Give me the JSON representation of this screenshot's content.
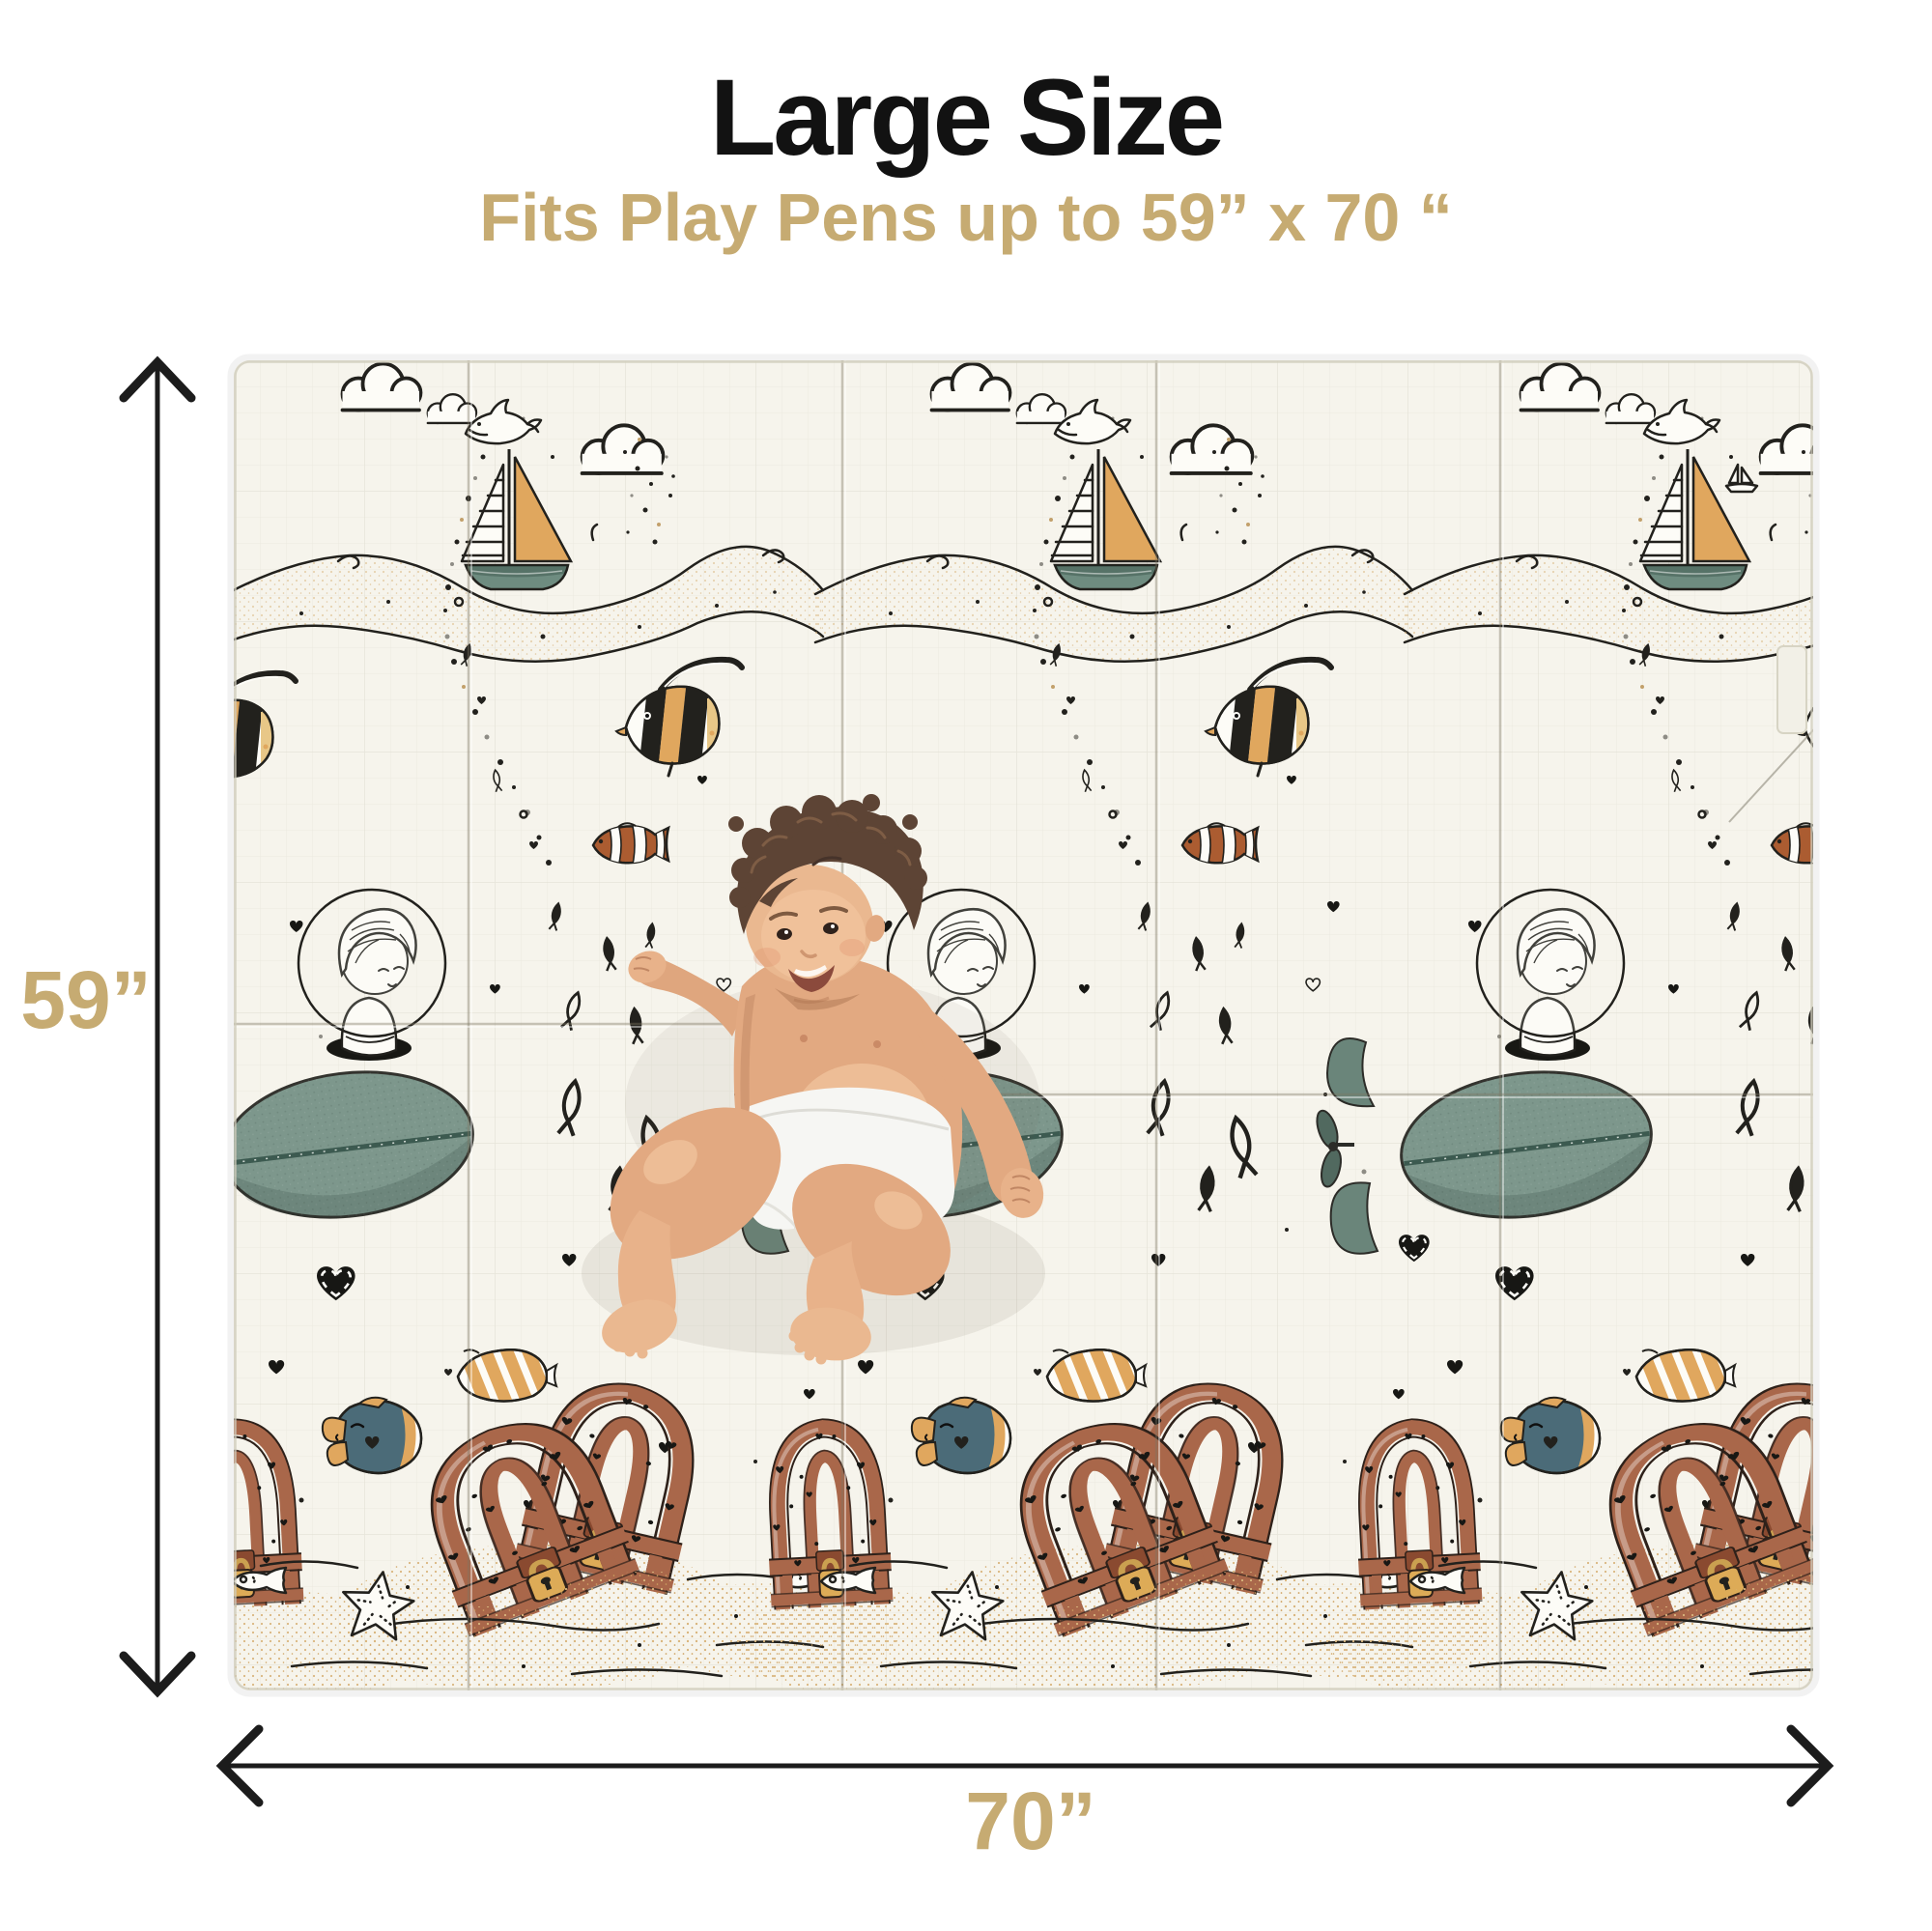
{
  "page": {
    "type": "product-size-infographic",
    "background": "#ffffff"
  },
  "header": {
    "title": "Large Size",
    "subtitle": "Fits Play Pens up to 59” x 70 “",
    "title_color": "#121212",
    "subtitle_color": "#c6ab72"
  },
  "dimensions": {
    "height_label": "59”",
    "width_label": "70”",
    "height_inches": 59,
    "width_inches": 70,
    "label_color": "#c6ab72",
    "arrow_color": "#1c1c1c"
  },
  "mat": {
    "background": "#f6f4ec",
    "style": "foldable baby play mat, sea-doodle print, 3 pattern repeats",
    "motifs": [
      "cloud-doodles",
      "jumping-dolphin",
      "sailboat-gold-sail",
      "ocean-wave-band",
      "moorish-idol-fish",
      "clownfish",
      "small-fish-school",
      "bubble-trail",
      "boy-in-bubble-helmet-submarine",
      "black-hearts",
      "stitched-hearts",
      "treasure-chests-with-padlocks",
      "blue-fish-gold-fins",
      "gold-striped-butterflyfish",
      "starfish-outline",
      "outline-fish",
      "sand-dunes"
    ],
    "palette": {
      "ink": "#22211d",
      "sail_gold": "#e0a75e",
      "hull_teal": "#6e8c80",
      "submarine_sage": "#7d978c",
      "chest_brown": "#a9674a",
      "lock_gold": "#ddab57",
      "sand_tan": "#d9b67e",
      "fish_blue": "#4b6b78",
      "clownfish_orange": "#ab5c31"
    }
  },
  "baby": {
    "description": "smiling baby wearing a white diaper lying on the mat"
  }
}
